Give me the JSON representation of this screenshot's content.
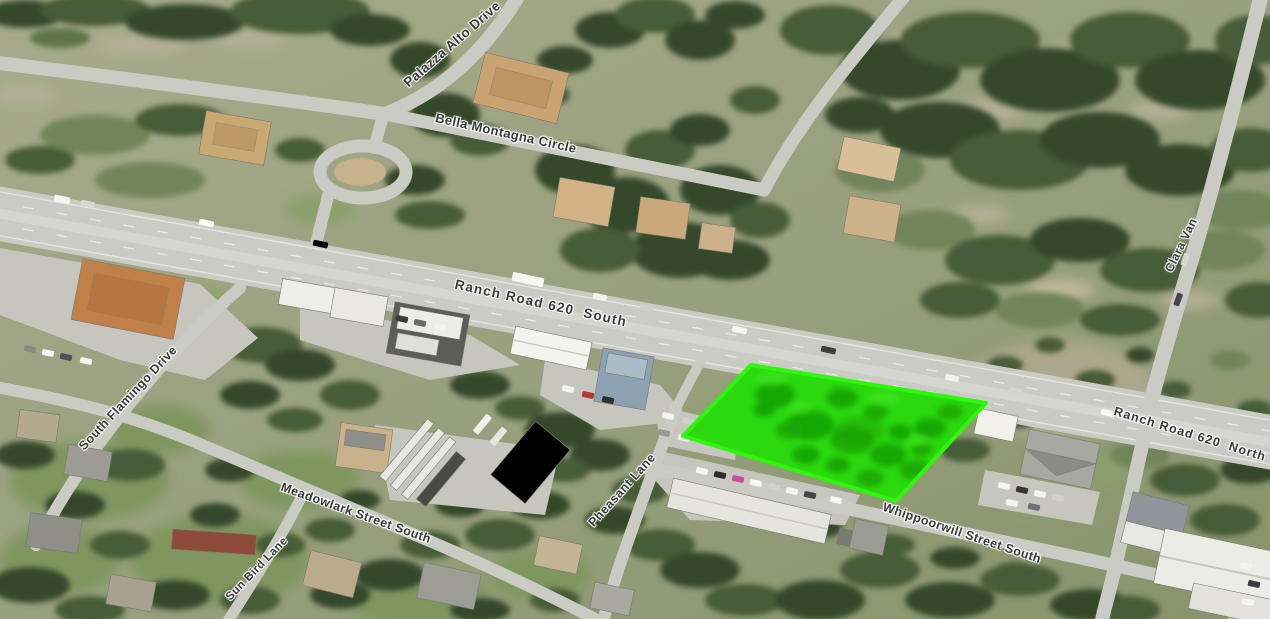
{
  "map_labels": {
    "palazza_alto_drive": "Palazza Alto Drive",
    "bella_montagna_circle": "Bella Montagna Circle",
    "ranch_road_620_south": "Ranch Road 620  South",
    "clara_van": "Clara Van",
    "south_flamingo_drive": "South Flamingo Drive",
    "meadowlark_street_south": "Meadowlark Street South",
    "sun_bird_lane": "Sun Bird Lane",
    "pheasant_lane": "Pheasant Lane",
    "ranch_road_620_north": "Ranch Road 620  North",
    "whippoorwill_street_south": "Whippoorwill Street South"
  },
  "parcel": {
    "fill_color": "#2bd90e",
    "border_color": "#2ef70c"
  }
}
